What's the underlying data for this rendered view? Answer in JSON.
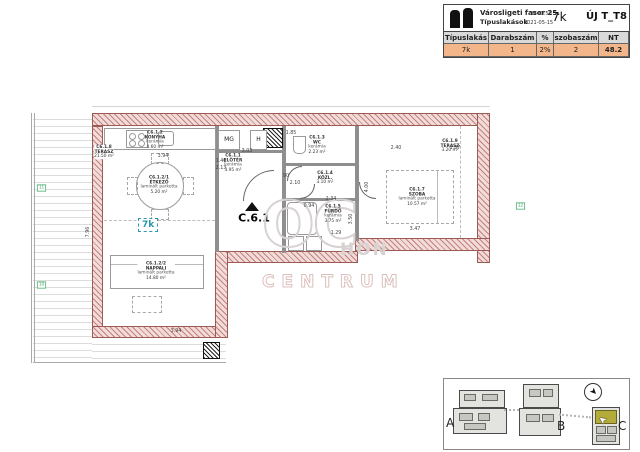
{
  "title_block": {
    "project": "Városligeti fasor 25.",
    "scale": "M=1:50",
    "subtitle": "Típuslakások",
    "date": "2021-05-15",
    "unit_type": "7k",
    "drawing_id": "ÚJ T_T8",
    "table": {
      "headers": [
        "Típuslakás",
        "Darabszám",
        "%",
        "szobaszám",
        "NT"
      ],
      "row": {
        "tipuslakas": "7k",
        "darabszam": "1",
        "percent": "2%",
        "szobaszam": "2",
        "nt": "48.2"
      }
    },
    "colors": {
      "header_bg": "#d9d9d9",
      "row_bg": "#f3b68b"
    }
  },
  "plan": {
    "unit_label": "C.6.1",
    "type_badge": "7k",
    "rooms": [
      {
        "id": "C6.1.1",
        "name": "ELŐTÉR",
        "floor": "kerámia",
        "area": "3.95 m²"
      },
      {
        "id": "C6.1.2",
        "name": "KONYHA",
        "floor": "kerámia",
        "area": "4.60 m²"
      },
      {
        "id": "C6.1.2/1",
        "name": "ÉTKEZŐ",
        "floor": "laminált parketta",
        "area": "5.20 m²"
      },
      {
        "id": "C6.1.2/2",
        "name": "NAPPALI",
        "floor": "laminált parketta",
        "area": "14.80 m²"
      },
      {
        "id": "C6.1.3",
        "name": "WC",
        "floor": "kerámia",
        "area": "2.23 m²"
      },
      {
        "id": "C6.1.4",
        "name": "KÖZL.",
        "floor": "kerámia",
        "area": "3.10 m²"
      },
      {
        "id": "C6.1.5",
        "name": "FÜRDŐ",
        "floor": "kerámia",
        "area": "3.75 m²"
      },
      {
        "id": "C6.1.7",
        "name": "SZOBA",
        "floor": "laminált parketta",
        "area": "10.57 m²"
      },
      {
        "id": "C6.1.8",
        "name": "TERASZ",
        "floor": "fagyálló kerámia",
        "area": "21.50 m²"
      },
      {
        "id": "C6.1.9",
        "name": "TERASZ",
        "floor": "fagyálló kerámia",
        "area": "3.20 m²"
      }
    ],
    "appliances": {
      "washing_machine": "MG",
      "fridge": "H"
    },
    "dimensions": [
      "3.94",
      "1.40",
      "2.13",
      "3.03",
      "1.85",
      "90",
      "2.10",
      "0.94",
      "2.40",
      "1.87",
      "4.00",
      "3.47",
      "2.34",
      "3.50",
      "1.29",
      "7.96",
      "3.94"
    ],
    "grid_markers": [
      "11",
      "10",
      "12"
    ],
    "watermark": {
      "initials": "OC",
      "fragment": "HON",
      "name2": "CENTRUM"
    }
  },
  "site_plan": {
    "buildings": [
      {
        "label": "A"
      },
      {
        "label": "B"
      },
      {
        "label": "C"
      }
    ],
    "highlight_color": "#b3ab3a"
  }
}
